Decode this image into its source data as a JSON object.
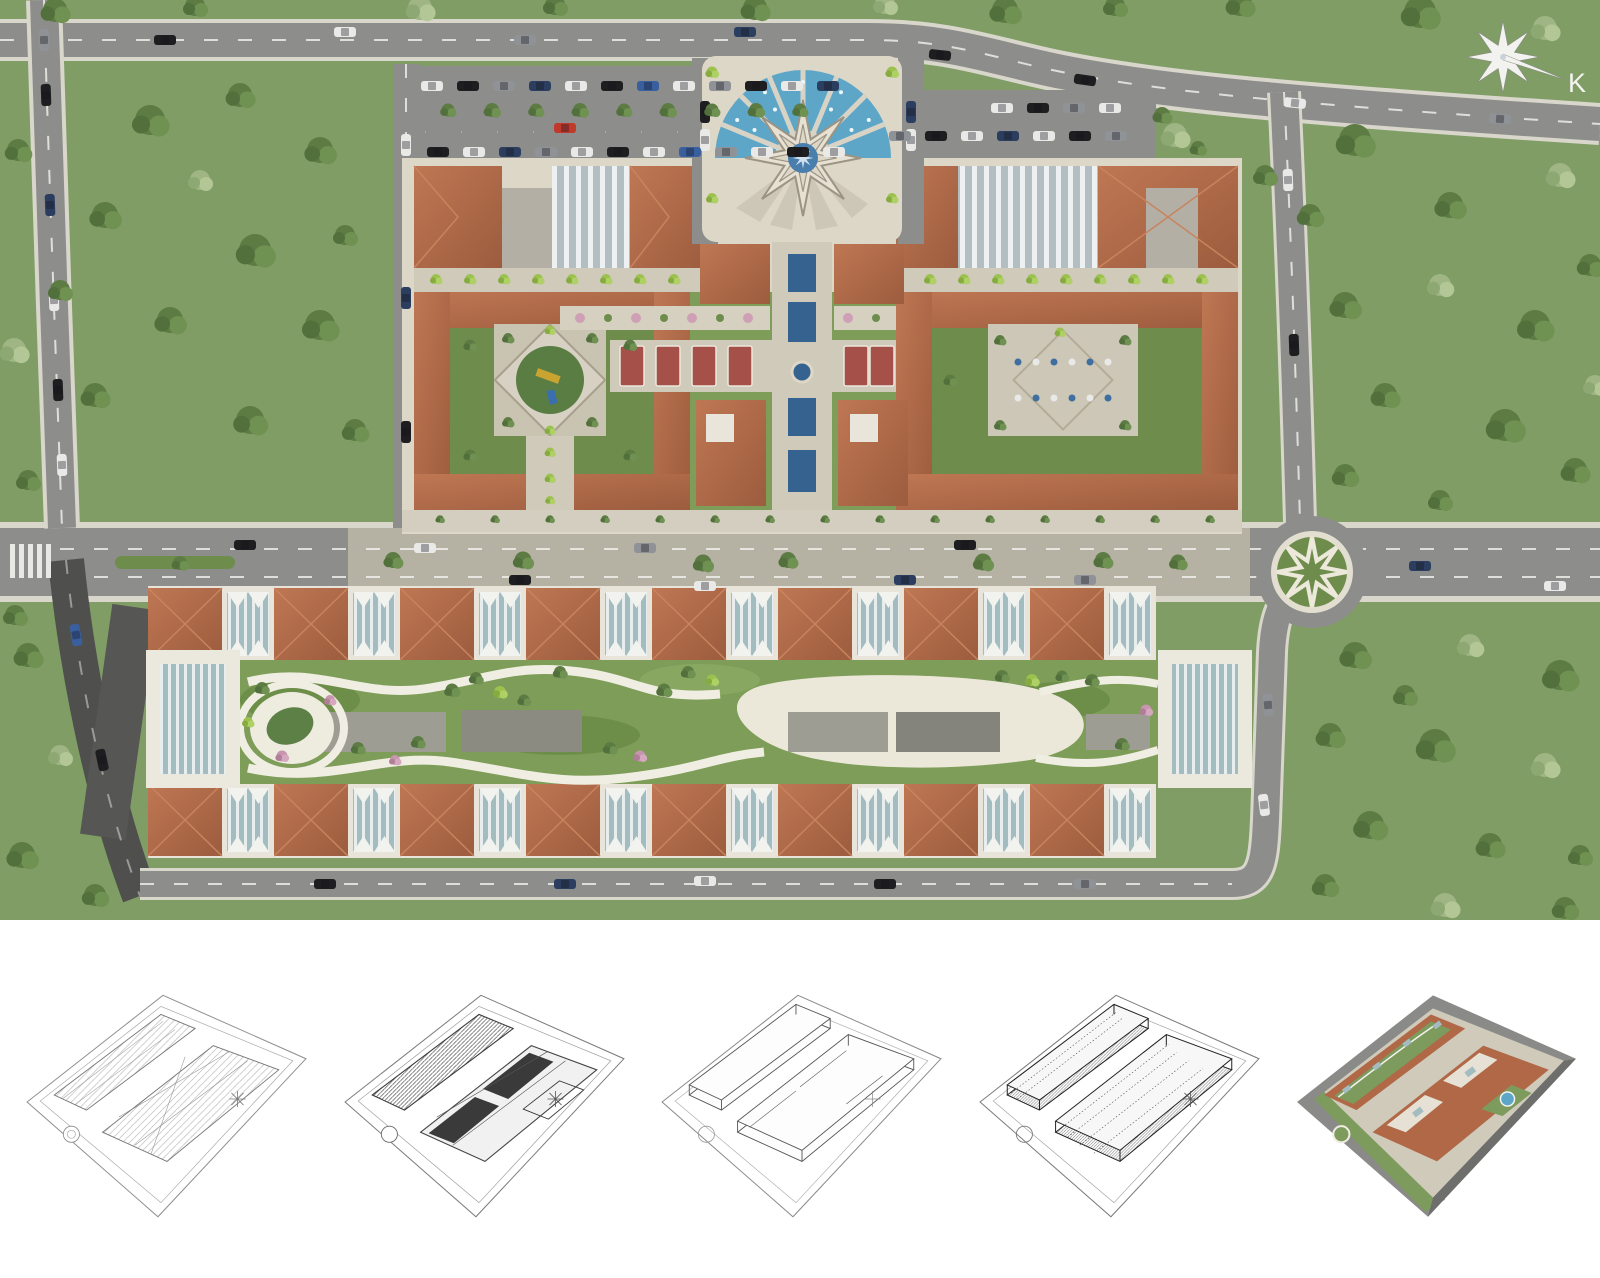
{
  "compass": {
    "label": "K"
  },
  "colors": {
    "grass": "#7f9d64",
    "lawn": "#7d9d58",
    "road": "#8d8d8b",
    "dark-road": "#4f4f4d",
    "sidewalk": "#d9d6cc",
    "boulevard": "#b5b1a3",
    "roof-orange": "#bf7753",
    "roof-orange-dark": "#9c5c3e",
    "roof-ridge": "#c8845e",
    "flat-roof": "#e9e5da",
    "skylight": "#b3bec2",
    "teal-roof": "#a3bcc0",
    "courtyard": "#6e8d4c",
    "pavement": "#dcd7c7",
    "pool": "#35628f",
    "fan": "#5ea6c8",
    "path": "#f0eee2",
    "pink": "#cf9fb6",
    "white": "#f4f3ee",
    "car-red": "#c0392b",
    "strip-bg": "#ffffff"
  },
  "site_features": [
    "star-fountain-plaza",
    "north-west-parking-lot",
    "north-east-parking-lot",
    "playground-courtyard",
    "cafe-courtyard",
    "central-axis-pools",
    "pergola-walkway",
    "central-boulevard",
    "roundabout-eight-point-star",
    "linear-park",
    "oval-pond",
    "row-housing",
    "compass-rose"
  ],
  "stages": [
    {
      "id": "stage-1",
      "kind": "2d-site-plan-drawing"
    },
    {
      "id": "stage-2",
      "kind": "site-plan-with-massing-footprints"
    },
    {
      "id": "stage-3",
      "kind": "3d-wireframe-massing"
    },
    {
      "id": "stage-4",
      "kind": "3d-wireframe-detailed-facades"
    },
    {
      "id": "stage-5",
      "kind": "full-color-3d-render"
    }
  ]
}
